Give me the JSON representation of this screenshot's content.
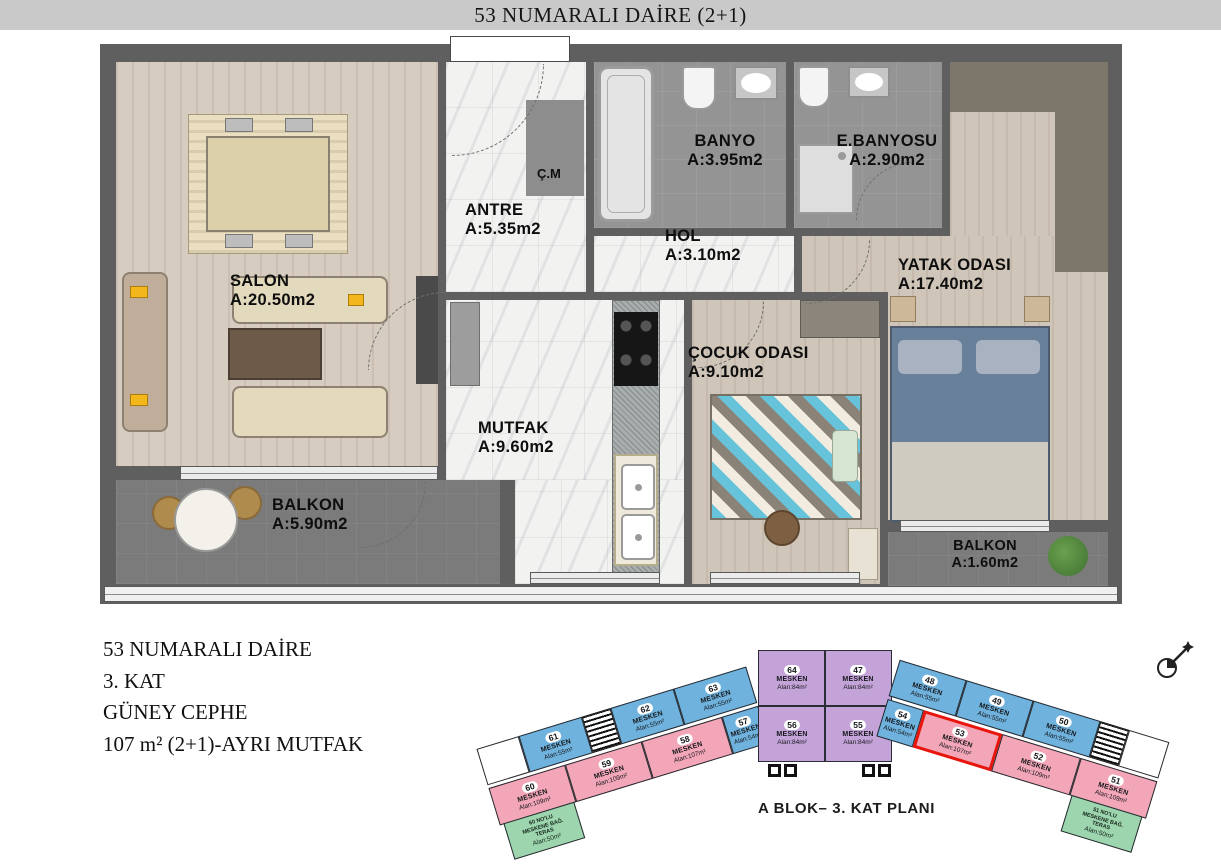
{
  "title": "53 NUMARALI DAİRE (2+1)",
  "plan": {
    "rooms": {
      "salon": {
        "name": "SALON",
        "area": "A:20.50m2"
      },
      "antre": {
        "name": "ANTRE",
        "area": "A:5.35m2"
      },
      "cm": {
        "name": "Ç.M"
      },
      "banyo": {
        "name": "BANYO",
        "area": "A:3.95m2"
      },
      "ebanyosu": {
        "name": "E.BANYOSU",
        "area": "A:2.90m2"
      },
      "hol": {
        "name": "HOL",
        "area": "A:3.10m2"
      },
      "mutfak": {
        "name": "MUTFAK",
        "area": "A:9.60m2"
      },
      "cocuk": {
        "name": "ÇOCUK ODASI",
        "area": "A:9.10m2"
      },
      "yatak": {
        "name": "YATAK ODASI",
        "area": "A:17.40m2"
      },
      "balkon_sol": {
        "name": "BALKON",
        "area": "A:5.90m2"
      },
      "balkon_sag": {
        "name": "BALKON",
        "area": "A:1.60m2"
      }
    }
  },
  "info": {
    "line1": "53 NUMARALI DAİRE",
    "line2": "3. KAT",
    "line3": "GÜNEY CEPHE",
    "line4": "107 m² (2+1)-AYRI MUTFAK"
  },
  "block_plan": {
    "caption": "A BLOK– 3. KAT PLANI",
    "colors": {
      "mesken_small_blue": "#6fb2dd",
      "mesken_large_pink": "#f2a6b8",
      "mesken_mid_purple": "#c4a3d9",
      "teras_green": "#9cd5ae",
      "highlight_red": "#e8150d"
    },
    "left_wing": {
      "top_units": [
        {
          "number": "61",
          "label": "MESKEN",
          "area": "Alan:55m²"
        },
        {
          "number": "62",
          "label": "MESKEN",
          "area": "Alan:55m²"
        },
        {
          "number": "63",
          "label": "MESKEN",
          "area": "Alan:55m²"
        }
      ],
      "bottom_units": [
        {
          "number": "60",
          "label": "MESKEN",
          "area": "Alan:109m²"
        },
        {
          "number": "59",
          "label": "MESKEN",
          "area": "Alan:109m²"
        },
        {
          "number": "58",
          "label": "MESKEN",
          "area": "Alan:107m²"
        },
        {
          "number": "57",
          "label": "MESKEN",
          "area": "Alan:54m²"
        }
      ],
      "teras": {
        "text": "60 NO'LU\nMESKENE BAĞ.\nTERAS",
        "area": "Alan:50m²"
      }
    },
    "middle_units": [
      {
        "number": "64",
        "label": "MESKEN",
        "area": "Alan:84m²"
      },
      {
        "number": "47",
        "label": "MESKEN",
        "area": "Alan:84m²"
      },
      {
        "number": "56",
        "label": "MESKEN",
        "area": "Alan:84m²"
      },
      {
        "number": "55",
        "label": "MESKEN",
        "area": "Alan:84m²"
      }
    ],
    "right_wing": {
      "top_units": [
        {
          "number": "48",
          "label": "MESKEN",
          "area": "Alan:55m²"
        },
        {
          "number": "49",
          "label": "MESKEN",
          "area": "Alan:55m²"
        },
        {
          "number": "50",
          "label": "MESKEN",
          "area": "Alan:55m²"
        }
      ],
      "bottom_units": [
        {
          "number": "54",
          "label": "MESKEN",
          "area": "Alan:54m²"
        },
        {
          "number": "53",
          "label": "MESKEN",
          "area": "Alan:107m²",
          "highlighted": true
        },
        {
          "number": "52",
          "label": "MESKEN",
          "area": "Alan:109m²"
        },
        {
          "number": "51",
          "label": "MESKEN",
          "area": "Alan:109m²"
        }
      ],
      "teras": {
        "text": "51 NO'LU\nMESKENE BAĞ.\nTERAS",
        "area": "Alan:50m²"
      }
    }
  }
}
